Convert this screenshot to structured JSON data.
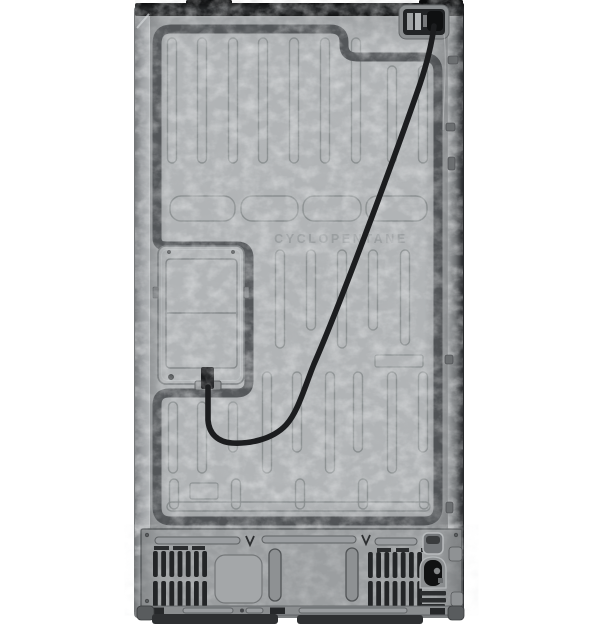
{
  "image": {
    "embossed_text": "CYCLOPENTANE"
  },
  "colors": {
    "background": "#ffffff",
    "panel": "#b1b4b6",
    "panel-light": "#c9cccd",
    "panel-dark": "#9a9da0",
    "groove": "#85898b",
    "channel": "#54575a",
    "cord": "#1c1d1f",
    "cap": "#141516",
    "compartment": "#9b9ea0",
    "vent-slot": "#232527",
    "base": "#2e3032"
  }
}
